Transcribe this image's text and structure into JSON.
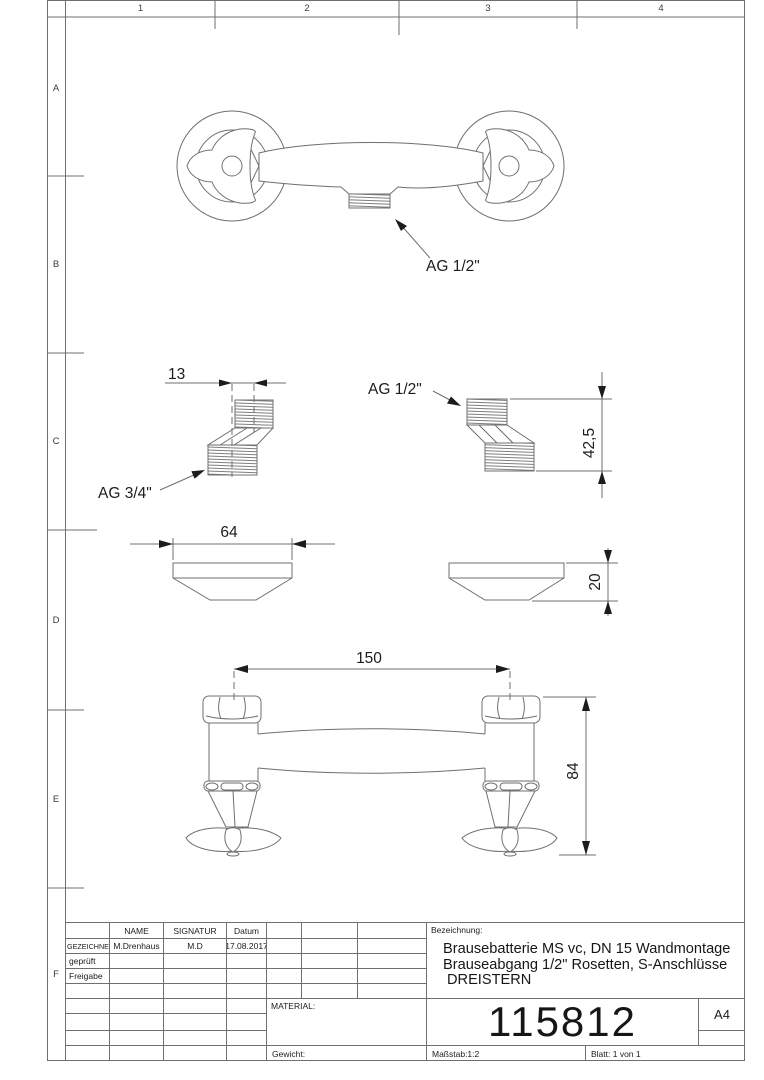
{
  "sheet": {
    "grid_cols": [
      "1",
      "2",
      "3",
      "4"
    ],
    "grid_rows": [
      "A",
      "B",
      "C",
      "D",
      "E",
      "F"
    ]
  },
  "title_block": {
    "header": {
      "name": "NAME",
      "signatur": "SIGNATUR",
      "datum": "Datum"
    },
    "rows": [
      {
        "label": "GEZEICHNET",
        "name": "M.Drenhaus",
        "signatur": "M.D",
        "datum": "17.08.2017"
      },
      {
        "label": "geprüft",
        "name": "",
        "signatur": "",
        "datum": ""
      },
      {
        "label": "Freigabe",
        "name": "",
        "signatur": "",
        "datum": ""
      }
    ],
    "bezeichnung_label": "Bezeichnung:",
    "bezeichnung_lines": [
      "Brausebatterie MS vc, DN 15 Wandmontage",
      "Brauseabgang 1/2\" Rosetten, S-Anschlüsse",
      "DREISTERN"
    ],
    "material_label": "MATERIAL:",
    "part_number": "115812",
    "paper_size": "A4",
    "gewicht_label": "Gewicht:",
    "massstab": "Maßstab:1:2",
    "blatt": "Blatt: 1 von 1"
  },
  "drawing": {
    "annotations": {
      "outlet_thread": "AG 1/2\"",
      "s_offset": "13",
      "s_thread_small": "AG 1/2\"",
      "s_height": "42,5",
      "s_thread_large": "AG 3/4\"",
      "rosette_width": "64",
      "rosette_height": "20",
      "center_distance": "150",
      "overall_height": "84"
    }
  },
  "colors": {
    "line": "#6f6f6f",
    "ink": "#1c1c1c"
  }
}
